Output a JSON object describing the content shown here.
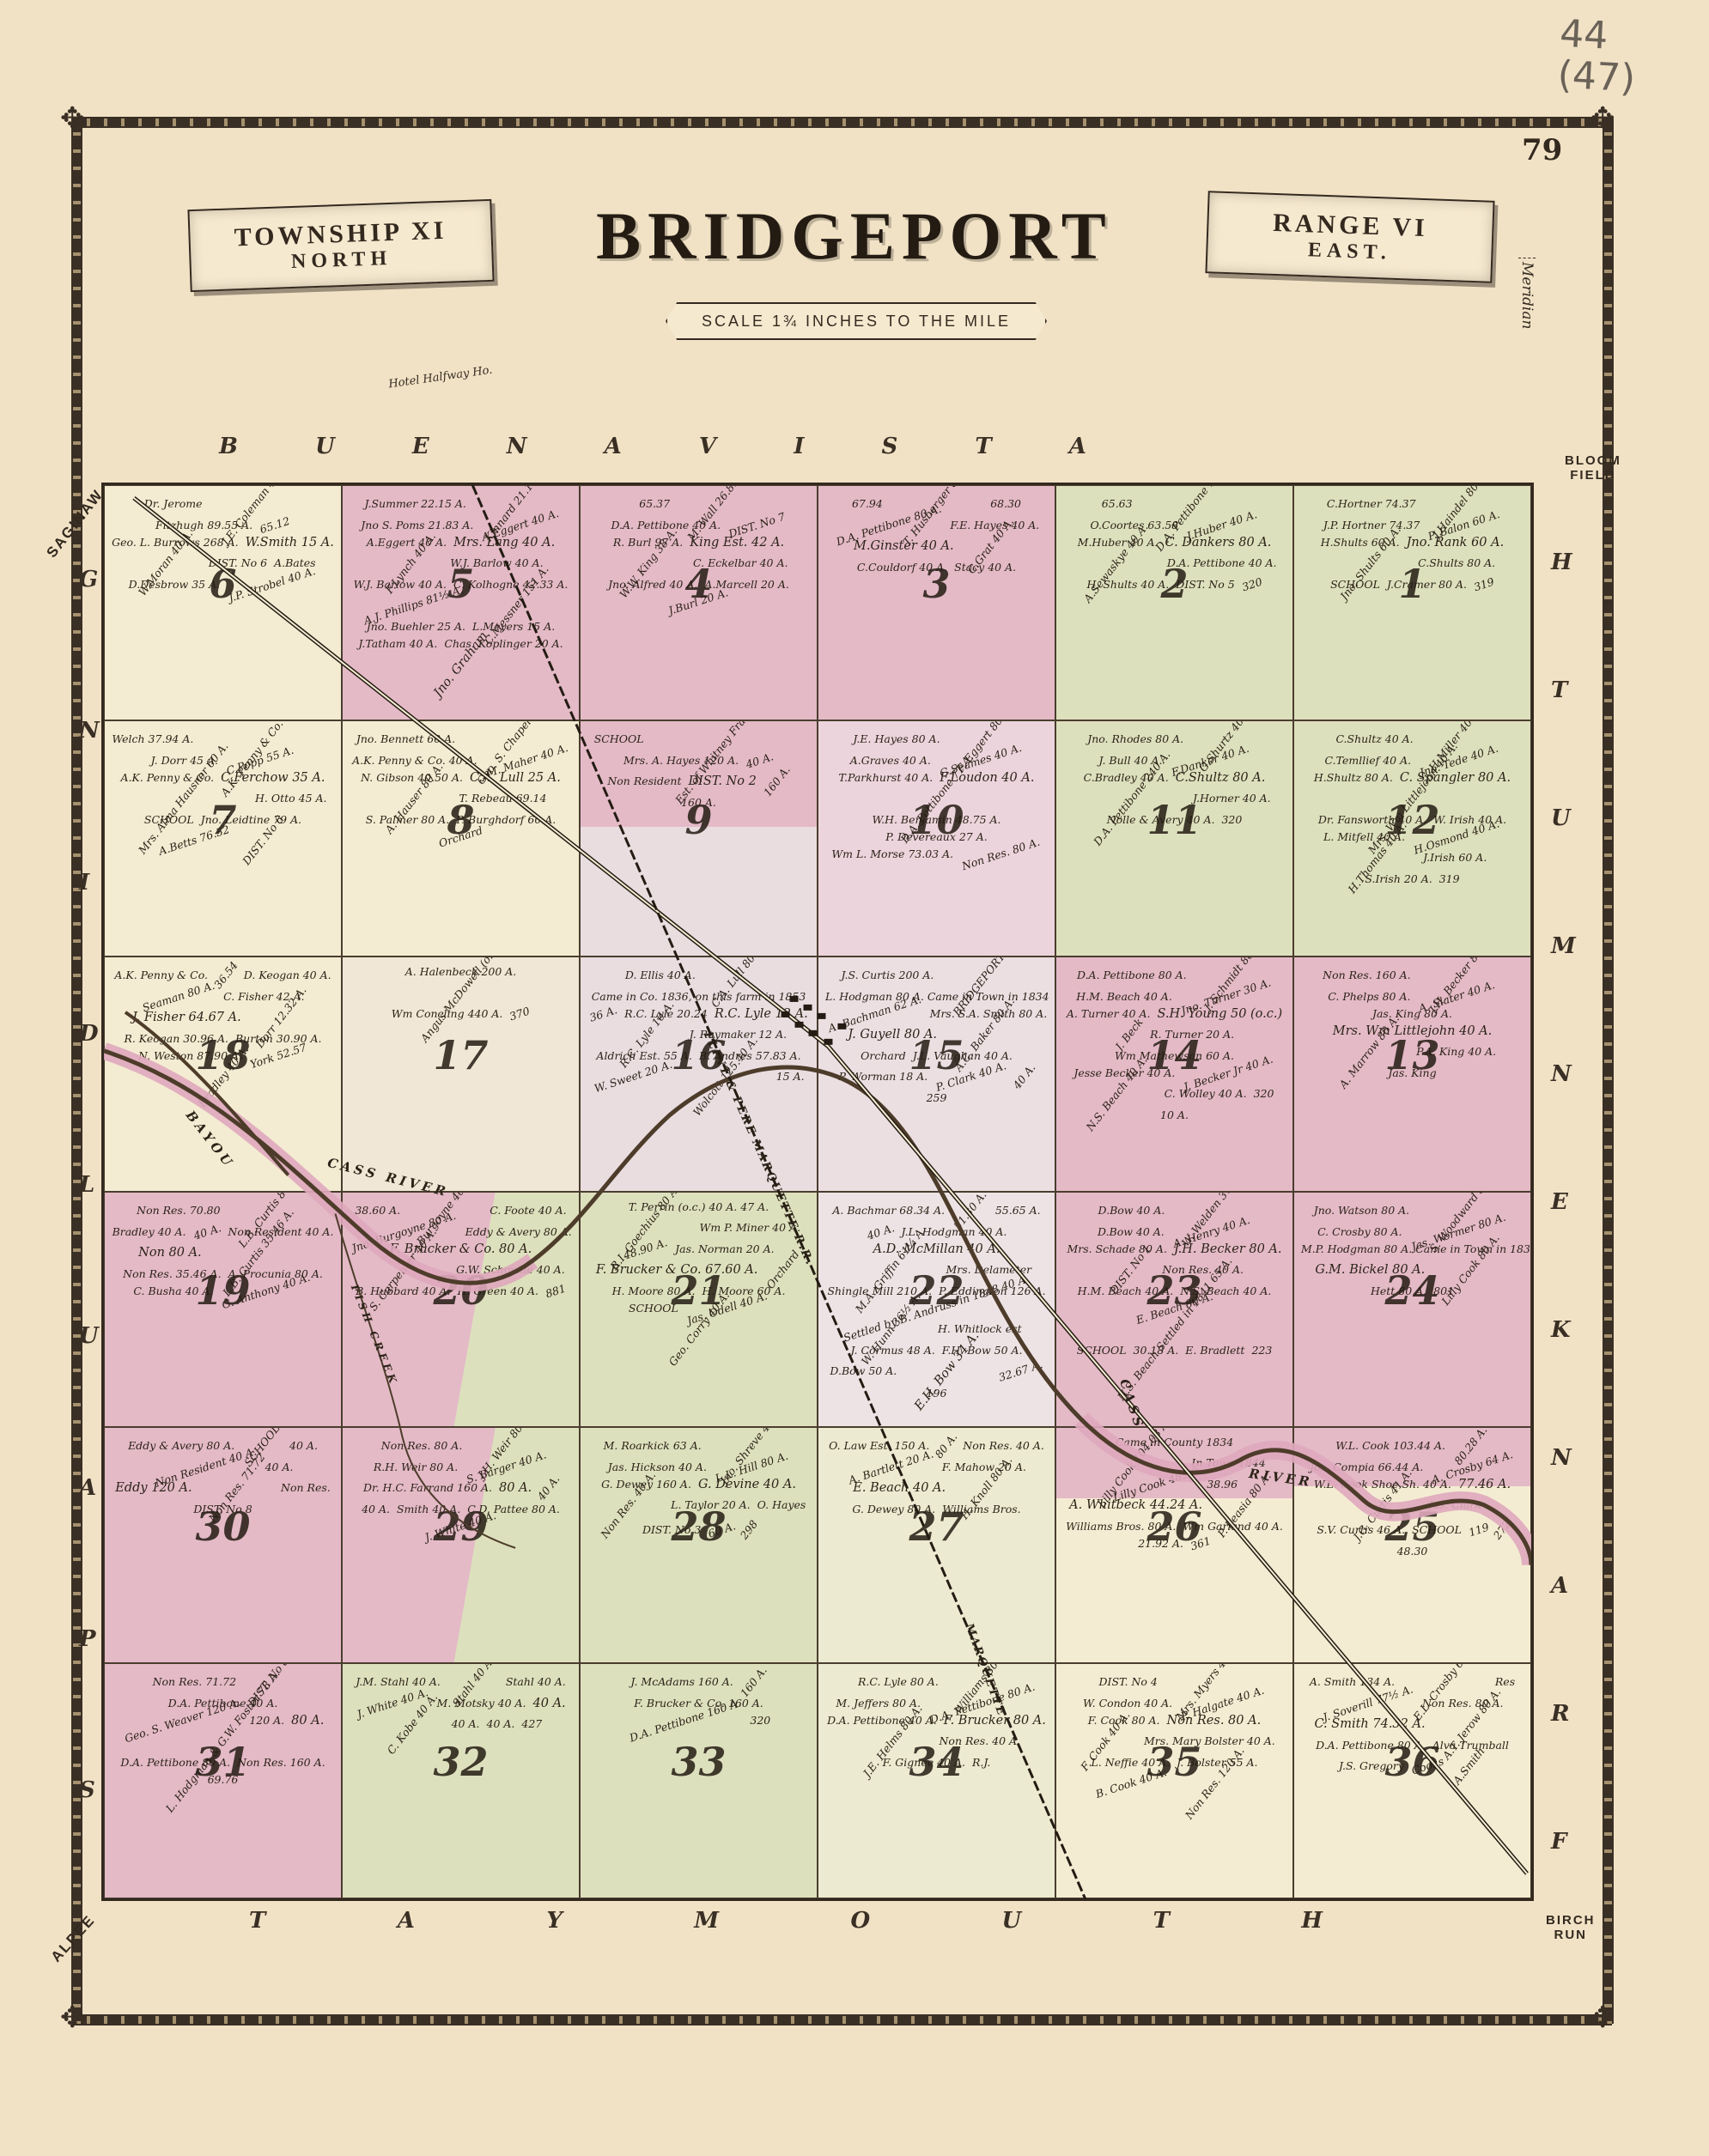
{
  "page": {
    "handwritten": "44\n(47)",
    "page_number": "79"
  },
  "title": {
    "left_banner_line1": "TOWNSHIP XI",
    "left_banner_line2": "NORTH",
    "main": "BRIDGEPORT",
    "right_banner_line1": "RANGE VI",
    "right_banner_line2": "EAST.",
    "scale": "SCALE 1¾ INCHES TO THE MILE",
    "meridian": "Meridian"
  },
  "edges": {
    "top_letters": [
      "B",
      "U",
      "E",
      "N",
      "A",
      "V",
      "I",
      "S",
      "T",
      "A"
    ],
    "bottom_letters": [
      "T",
      "A",
      "Y",
      "M",
      "O",
      "U",
      "T",
      "H"
    ],
    "left_letters": [
      "G",
      "N",
      "I",
      "D",
      "L",
      "U",
      "A",
      "P",
      "S"
    ],
    "right_letters": [
      "H",
      "T",
      "U",
      "M",
      "N",
      "E",
      "K",
      "N",
      "A",
      "R",
      "F"
    ],
    "corner_top_left": "SAGINAW",
    "corner_top_right": "BLOOM\nFIELD",
    "corner_bottom_left": "ALPEE",
    "corner_bottom_right": "BIRCH\nRUN",
    "hotel_note": "Hotel Halfway Ho."
  },
  "features": {
    "river_main": "CASS RIVER",
    "river_cass_vert": "CASS",
    "river_east": "RIVER",
    "bayou": "BAYOU",
    "creek": "FISH CREEK",
    "railroad": "FLINT & PERE MARQUETTE R.R.",
    "marquette": "MARQUETTE",
    "ink_color": "#33291f",
    "pink": "#e4bac7",
    "green": "#dde0bd",
    "cream": "#f4ecd2",
    "lavender": "#e9dde0"
  },
  "map": {
    "sections": [
      {
        "number": 6,
        "color": "#f4ecd2",
        "parcels": [
          "Dr. Jerome",
          "J.E. Coleman 40 A.",
          "Fitzhugh 89.55 A.",
          "65.12",
          "Geo. L. Burrows 268 A.",
          "W.Smith 15 A.",
          "W.Moran 40 A.",
          "DIST. No 6",
          "A.Bates",
          "D.Desbrow 35 A.",
          "J.P. Strobel 40 A."
        ]
      },
      {
        "number": 5,
        "color": "#e4bac7",
        "parcels": [
          "J.Summer 22.15 A.",
          "Kinnard 21.14 A.",
          "Jno S. Poms 21.83 A.",
          "A.Eggert 40 A.",
          "A.Eggert 40 A.",
          "Mrs. Lang 40 A.",
          "F.Lynch 40 A.",
          "W.J. Barlow 40 A.",
          "W.J. Barlow 40 A.",
          "C. Kolhogne 42.33 A.",
          "A.J. Phillips 81½ A.",
          "C.Messner 151 A.",
          "Jno. Buehler 25 A.",
          "L.Meyers 15 A.",
          "J.Tatham 40 A.",
          "Chas. Koplinger 20 A.",
          "Jno. Graham"
        ]
      },
      {
        "number": 4,
        "color": "#e4bac7",
        "parcels": [
          "65.37",
          "M. Wall 26.81 A.",
          "D.A. Pettibone 40 A.",
          "DIST. No 7",
          "R. Burl 97 A.",
          "King Est. 42 A.",
          "W.W. King 38 A.",
          "C. Eckelbar 40 A.",
          "Jno. Alfred 40 A.",
          "A.Marcell 20 A.",
          "J.Burl 20 A."
        ]
      },
      {
        "number": 3,
        "color": "#e4bac7",
        "parcels": [
          "67.94",
          "T. Husberger 80 A.",
          "68.30",
          "D.A. Pettibone 80 A.",
          "F.E. Hayes 40 A.",
          "M.Ginster 40 A.",
          "C.Grat 40 A.",
          "C.Couldorf 40 A.",
          "Stacy 40 A."
        ]
      },
      {
        "number": 2,
        "color": "#dde0bd",
        "parcels": [
          "65.63",
          "D.A. Pettibone 160 A.",
          "O.Coortes 63.58",
          "J.Huber 40 A.",
          "M.Huber 40 A.",
          "C. Dankers 80 A.",
          "A.Sewaskye 40 A.",
          "D.A. Pettibone 40 A.",
          "H. Shults 40 A.",
          "DIST. No 5",
          "320"
        ]
      },
      {
        "number": 1,
        "color": "#dde0bd",
        "parcels": [
          "C.Hortner 74.37",
          "J.Haindel 80.72",
          "J.P. Hortner 74.37",
          "P. Balon 60 A.",
          "H.Shults 60 A.",
          "Jno. Rank 60 A.",
          "Jno. Shults 60 A.",
          "C.Shults 80 A.",
          "SCHOOL",
          "J.Cramer 80 A.",
          "319"
        ]
      },
      {
        "number": 7,
        "color": "#f4ecd2",
        "parcels": [
          "Welch 37.94 A.",
          "A.K. Penny & Co. 37.94 A.",
          "J. Dorr 45 A.",
          "C.Popp 55 A.",
          "A.K. Penny & Co.",
          "C.Ferchow 35 A.",
          "Mrs. Alma Hausner 60 A.",
          "H. Otto 45 A.",
          "SCHOOL",
          "Jno. Leidtine 79 A.",
          "A.Betts 76.52",
          "DIST. No 6"
        ]
      },
      {
        "number": 8,
        "color": "#f4ecd2",
        "parcels": [
          "Jno. Bennett 60 A.",
          "Geo. S. Chapel 58 A.",
          "A.K. Penny & Co. 40 A.",
          "M. Maher 40 A.",
          "N. Gibson 40.50 A.",
          "C.A. Lull 25 A.",
          "A. Hauser 80 A.",
          "T. Rebeau 69.14",
          "S. Palmer 80 A.",
          "P. Burghdorf 60 A.",
          "Orchard"
        ]
      },
      {
        "number": 9,
        "color": "linear-gradient(#e4bac7 45%,#e9dde0 45%)",
        "parcels": [
          "SCHOOL",
          "Est. of Whitney Fraser 320 A.",
          "Mrs. A. Hayes 120 A.",
          "40 A.",
          "Non Resident",
          "DIST. No 2",
          "160 A.",
          "160 A."
        ]
      },
      {
        "number": 10,
        "color": "#ecd4dc",
        "parcels": [
          "J.E. Hayes 80 A.",
          "F. Eggert 80 A.",
          "A.Graves 40 A.",
          "G.Seames 40 A.",
          "T.Parkhurst 40 A.",
          "F.Loudon 40 A.",
          "D.A. Pettibone 77 A.",
          "W.H. Benjamin 48.75 A.",
          "P. Devereaux 27 A.",
          "Wm L. Morse 73.03 A.",
          "Non Res. 80 A."
        ]
      },
      {
        "number": 11,
        "color": "#dde0bd",
        "parcels": [
          "Jno. Rhodes 80 A.",
          "G.Shurtz 40 A.",
          "J. Bull 40 A.",
          "F.Danker 40 A.",
          "C.Bradley 40 A.",
          "C.Shultz 80 A.",
          "D.A. Pettibone 240 A.",
          "J.Horner 40 A.",
          "Nolle & Avery 40 A.",
          "320"
        ]
      },
      {
        "number": 12,
        "color": "#dde0bd",
        "parcels": [
          "C.Shultz 40 A.",
          "H.Miller 40 A.",
          "C.Temllief 40 A.",
          "Jno. Tede 40 A.",
          "H.Shultz 80 A.",
          "C. Spangler 80 A.",
          "Mrs. Wm Littlejohn 40 A.",
          "Dr. Fansworth 40 A.",
          "W. Irish 40 A.",
          "L. Mitfell 40 A.",
          "H.Osmond 40 A.",
          "H.Thomas 40 A.",
          "J.Irish 60 A.",
          "S.Irish 20 A.",
          "319"
        ]
      },
      {
        "number": 18,
        "color": "#f4ecd2",
        "parcels": [
          "A.K. Penny & Co.",
          "36.54",
          "D. Keogan 40 A.",
          "Seaman 80 A.",
          "C. Fisher 42 A.",
          "J. Fisher 64.67 A.",
          "Dorr 12.32 A.",
          "R. Keogan 30.96 A.",
          "Burton 30.90 A.",
          "N. Weston 87.90 A.",
          "York 52.57",
          "Bradley 40 A."
        ]
      },
      {
        "number": 17,
        "color": "#f0e7d6",
        "parcels": [
          "A. Halenbeck 200 A.",
          "Angus McDowell (o.c.)",
          "Wm Concling 440 A.",
          "370"
        ]
      },
      {
        "number": 16,
        "color": "#e9dde0",
        "parcels": [
          "D. Ellis 40 A.",
          "C.A. Lull 80 A.",
          "Came in Co. 1836, on this farm in 1853",
          "36 A.",
          "R.C. Lyle 20.24",
          "R.C. Lyle 12 A.",
          "R.C. Lyle 10 A.",
          "J. Raymaker 12 A.",
          "Aldrich Est. 55 A.",
          "B. Andres 57.83 A.",
          "W. Sweet 20 A.",
          "Wolcott 125.40 A.",
          "15 A."
        ]
      },
      {
        "number": 15,
        "color": "#ecdfe2",
        "parcels": [
          "J.S. Curtis 200 A.",
          "BRIDGEPORT P.O.",
          "L. Hodgman 80 A. Came in Town in 1834",
          "A. Bachman 62 A.",
          "Mrs. S.A. Smith 80 A.",
          "J. Guyell 80 A.",
          "A.C. Baker 80 A.",
          "Orchard",
          "J.L. Vaughan 40 A.",
          "P. Worman 18 A.",
          "P. Clark 40 A.",
          "40 A.",
          "259"
        ]
      },
      {
        "number": 14,
        "color": "#e4bac7",
        "parcels": [
          "D.A. Pettibone 80 A.",
          "J. Schmidt 80 A.",
          "H.M. Beach 40 A.",
          "Jno. Turner 30 A.",
          "A. Turner 40 A.",
          "S.H. Young 50 (o.c.)",
          "J. Beck",
          "R. Turner 20 A.",
          "Wm Mathewson 60 A.",
          "Jesse Becker 40 A.",
          "J. Becker Jr 40 A.",
          "N.S. Beach 40 A.",
          "C. Wolley 40 A.",
          "320",
          "10 A."
        ]
      },
      {
        "number": 13,
        "color": "#e4bac7",
        "parcels": [
          "Non Res. 160 A.",
          "J.H. Becker 80 A.",
          "C. Phelps 80 A.",
          "A. Slater 40 A.",
          "Jas. King 80 A.",
          "Mrs. Wm Littlejohn 40 A.",
          "A. Marrow 80 A.",
          "P.A. King 40 A.",
          "Jas. King"
        ]
      },
      {
        "number": 19,
        "color": "#e4bac7",
        "parcels": [
          "Non Res. 70.80",
          "L.B. Curtis 80 A.",
          "Bradley 40 A.",
          "40 A.",
          "Non Resident 40 A.",
          "Non 80 A.",
          "L.B. Curtis 35.46 A.",
          "Non Res. 35.46 A.",
          "A. Procunia 80 A.",
          "C. Busha 40 A.",
          "G. Anthony 40 A."
        ]
      },
      {
        "number": 20,
        "color": "linear-gradient(100deg,#e4bac7 55%,#dde0bd 55%)",
        "parcels": [
          "38.60 A.",
          "Burgoyne 40 A.",
          "C. Foote 40 A.",
          "Jno. Burgoyne 80 A.",
          "Eddy & Avery 80 A.",
          "F. Brucker & Co. 80 A.",
          "S. Carpenter 40 A.",
          "G.W. Schoville 40 A.",
          "B. Hubbard 40 A.",
          "H. Green 40 A.",
          "881"
        ]
      },
      {
        "number": 21,
        "color": "#dde0bd",
        "parcels": [
          "T. Perrin (o.c.) 40 A. 47 A.",
          "R.I. Goechius 80 A.",
          "Wm P. Miner 40 A.",
          "48.90 A.",
          "Jas. Norman 20 A.",
          "F. Brucker & Co. 67.60 A.",
          "Orchard",
          "H. Moore 80 A.",
          "H. Moore 60 A.",
          "SCHOOL",
          "Jas. Odell 40 A.",
          "Geo. Corry 40 A."
        ]
      },
      {
        "number": 22,
        "color": "#eee3e4",
        "parcels": [
          "A. Bachmar 68.34 A.",
          "51.30 A.",
          "55.65 A.",
          "40 A.",
          "J.L. Hodgman 40 A.",
          "A.D. McMillan 40 A.",
          "M.A. Griffin 61¼ A.",
          "Mrs. Delameter",
          "Shingle Mill 210 A.",
          "P. Eddington 126 A.",
          "Settled by B. Andruss in 1848 40 A.",
          "W. Hunn 36½ A.",
          "H. Whitlock est",
          "J. Cormus 48 A.",
          "F.H. Bow 50 A.",
          "D.Bow 50 A.",
          "E.H. Bow 34 A.",
          "32.67 A.",
          "196"
        ]
      },
      {
        "number": 23,
        "color": "#e4bac7",
        "parcels": [
          "D.Bow 40 A.",
          "W. Welden 37 A.",
          "D.Bow 40 A.",
          "A. Henry 40 A.",
          "Mrs. Schade 80 A.",
          "J.H. Becker 80 A.",
          "DIST. No 1",
          "Non Res. 40 A.",
          "H.M. Beach 40 A.",
          "N.S. Beach 40 A.",
          "E. Beach 80 A.",
          "N.S. Beach Settled in 1841 65 A.",
          "SCHOOL",
          "30.18 A.",
          "E. Bradlett",
          "223"
        ]
      },
      {
        "number": 24,
        "color": "#e4bac7",
        "parcels": [
          "Jno. Watson 80 A.",
          "S. Woodward 80 A.",
          "C. Crosby 80 A.",
          "Jas. Wormer 80 A.",
          "M.P. Hodgman 80 A. Came in Town in 1834",
          "G.M. Bickel 80 A.",
          "Lilly Cook 80 A.",
          "Hett 80 A.",
          "801"
        ]
      },
      {
        "number": 30,
        "color": "#e4bac7",
        "parcels": [
          "Eddy & Avery 80 A.",
          "SCHOOL",
          "40 A.",
          "Non Resident 40 A.",
          "40 A.",
          "Eddy 120 A.",
          "Non Res. 71.72",
          "Non Res.",
          "DIST. No 8"
        ]
      },
      {
        "number": 29,
        "color": "linear-gradient(100deg,#e4bac7 55%,#dde0bd 55%)",
        "parcels": [
          "Non Res. 80 A.",
          "J.H. Weir 80 A.",
          "R.H. Weir 80 A.",
          "S. Barger 40 A.",
          "Dr. H.C. Farrand 160 A.",
          "80 A.",
          "40 A.",
          "40 A.",
          "Smith 40 A.",
          "C.D. Pattee 80 A.",
          "J. White 40 A."
        ]
      },
      {
        "number": 28,
        "color": "#dde0bd",
        "parcels": [
          "M. Roarkick 63 A.",
          "Jno. Shreve 40 A.",
          "Jas. Hickson 40 A.",
          "L.L. Hill 80 A.",
          "G. Dewey 160 A.",
          "G. Devine 40 A.",
          "Non Res. 40 A.",
          "L. Taylor 20 A.",
          "O. Hayes",
          "DIST. No 3",
          "60 A.",
          "298"
        ]
      },
      {
        "number": 27,
        "color": "#ecead0",
        "parcels": [
          "O. Law Est. 150 A.",
          "80 A.",
          "Non Res. 40 A.",
          "A. Bartlett 20 A.",
          "F. Mahow 20 A.",
          "E. Beach 40 A.",
          "H. Knoll 80 A.",
          "G. Dewey 80 A.",
          "Williams Bros."
        ]
      },
      {
        "number": 26,
        "color": "linear-gradient(#e4bac7 30%,#f4ecd2 30%)",
        "parcels": [
          "Came in County 1834",
          "Lilly Cook 104.08 A.",
          "In Town 1844",
          "Lilly Cook 48.30",
          "38.96",
          "A. Whitbeck 44.24 A.",
          "P. Leasia 80 A.",
          "Williams Bros. 80 A.",
          "Wm Garland 40 A.",
          "21.92 A.",
          "361"
        ]
      },
      {
        "number": 25,
        "color": "linear-gradient(#e4bac7 25%,#f4ecd2 25%)",
        "parcels": [
          "W.L. Cook 103.44 A.",
          "80.28 A.",
          "Jos. Compia 66.44 A.",
          "A. Crosby 64 A.",
          "W.L. Cook Shoe Sh. 40 A.",
          "77.46 A.",
          "J.G. Curtis 41 A.",
          "Jas. Clark",
          "S.V. Curtis 46 A.",
          "SCHOOL",
          "119",
          "272",
          "48.30"
        ]
      },
      {
        "number": 31,
        "color": "#e4bac7",
        "parcels": [
          "Non Res. 71.72",
          "DIST. No 8",
          "D.A. Pettibone 40 A.",
          "Geo. S. Weaver 120 A.",
          "120 A.",
          "80 A.",
          "L. Hodgman & G.W. Foster 78 A.",
          "D.A. Pettibone 80 A.",
          "Non Res. 160 A.",
          "69.76"
        ]
      },
      {
        "number": 32,
        "color": "#dde0bd",
        "parcels": [
          "J.M. Stahl 40 A.",
          "Stahl 40 A.",
          "Stahl 40 A.",
          "J. White 40 A.",
          "M. Motsky 40 A.",
          "40 A.",
          "C. Kobe 40 A.",
          "40 A.",
          "40 A.",
          "427"
        ]
      },
      {
        "number": 33,
        "color": "#dde0bd",
        "parcels": [
          "J. McAdams 160 A.",
          "160 A.",
          "F. Brucker & Co. 160 A.",
          "D.A. Pettibone 160 A.",
          "320"
        ]
      },
      {
        "number": 34,
        "color": "#ecead0",
        "parcels": [
          "R.C. Lyle 80 A.",
          "Williams 80 A.",
          "M. Jeffers 80 A.",
          "D.A. Pettibone 80 A.",
          "D.A. Pettibone 40 A.",
          "F. Brucker 80 A.",
          "J.E. Helms 80 A.",
          "Non Res. 40 A.",
          "F. Gignee 40 A.",
          "R.J."
        ]
      },
      {
        "number": 35,
        "color": "#f4ecd2",
        "parcels": [
          "DIST. No 4",
          "Mrs. Myers 40 A.",
          "W. Condon 40 A.",
          "P. Halgate 40 A.",
          "F. Cook 80 A.",
          "Non Res. 80 A.",
          "F. Cook 40 A.",
          "Mrs. Mary Bolster 40 A.",
          "L. Neffie 40 A.",
          "J. Bolster 55 A.",
          "B. Cook 40 A.",
          "Non Res. 120 A."
        ]
      },
      {
        "number": 36,
        "color": "#f4ecd2",
        "parcels": [
          "A. Smith 134 A.",
          "E.L. Crosby 60 A.",
          "Res",
          "J. Soverill 77½ A.",
          "Non Res. 80 A.",
          "C. Smith 74.32 A.",
          "A.T. Jerow 80 A.",
          "D.A. Pettibone 80 A.",
          "Alva Trumball",
          "J.S. Gregory",
          "Cooks",
          "A.Smith"
        ]
      }
    ]
  }
}
